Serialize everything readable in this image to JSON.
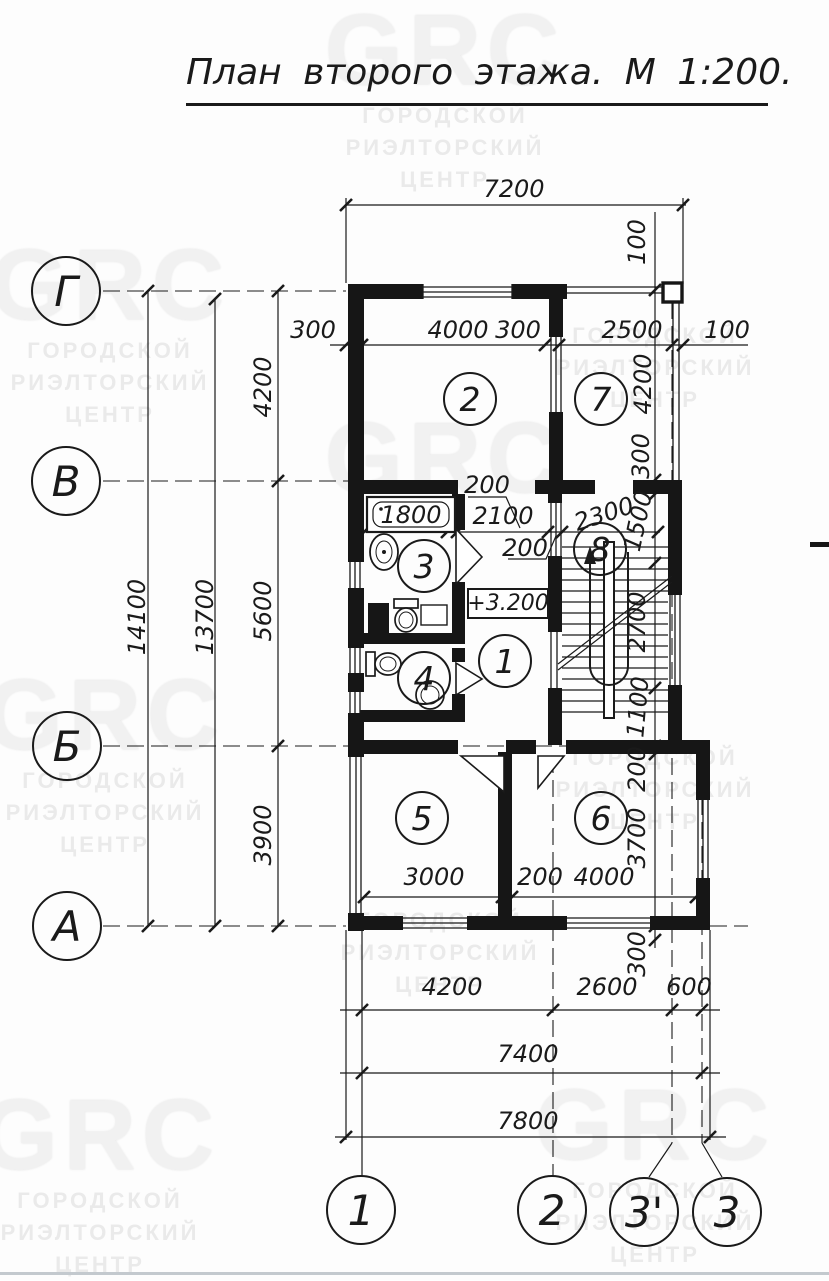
{
  "title": "План второго этажа. М 1:200.",
  "watermark": {
    "brand": "GRC",
    "lines": [
      "ГОРОДСКОЙ",
      "РИЭЛТОРСКИЙ",
      "ЦЕНТР"
    ]
  },
  "level_mark": "+3.200",
  "axes": {
    "left": [
      {
        "label": "Г",
        "x": 66,
        "y": 291
      },
      {
        "label": "В",
        "x": 66,
        "y": 481
      },
      {
        "label": "Б",
        "x": 67,
        "y": 746
      },
      {
        "label": "А",
        "x": 67,
        "y": 926
      }
    ],
    "bottom": [
      {
        "label": "1",
        "x": 361,
        "y": 1210
      },
      {
        "label": "2",
        "x": 552,
        "y": 1210
      },
      {
        "label": "3'",
        "x": 644,
        "y": 1212
      },
      {
        "label": "3",
        "x": 727,
        "y": 1212
      }
    ]
  },
  "rooms": [
    {
      "number": "2",
      "x": 470,
      "y": 399
    },
    {
      "number": "7",
      "x": 601,
      "y": 399
    },
    {
      "number": "3",
      "x": 424,
      "y": 566
    },
    {
      "number": "4",
      "x": 424,
      "y": 678
    },
    {
      "number": "1",
      "x": 505,
      "y": 661
    },
    {
      "number": "8",
      "x": 600,
      "y": 549
    },
    {
      "number": "5",
      "x": 422,
      "y": 818
    },
    {
      "number": "6",
      "x": 601,
      "y": 818
    }
  ],
  "dim_labels": [
    {
      "text": "7200",
      "x": 514,
      "y": 189,
      "r": 0
    },
    {
      "text": "100",
      "x": 637,
      "y": 242,
      "r": -90
    },
    {
      "text": "300",
      "x": 313,
      "y": 330,
      "r": 0
    },
    {
      "text": "4000",
      "x": 458,
      "y": 330,
      "r": 0
    },
    {
      "text": "300",
      "x": 518,
      "y": 330,
      "r": 0
    },
    {
      "text": "2500",
      "x": 632,
      "y": 330,
      "r": 0
    },
    {
      "text": "100",
      "x": 727,
      "y": 330,
      "r": 0
    },
    {
      "text": "14100",
      "x": 137,
      "y": 617,
      "r": -90
    },
    {
      "text": "13700",
      "x": 205,
      "y": 617,
      "r": -90
    },
    {
      "text": "4200",
      "x": 263,
      "y": 387,
      "r": -90
    },
    {
      "text": "5600",
      "x": 263,
      "y": 611,
      "r": -90
    },
    {
      "text": "3900",
      "x": 263,
      "y": 835,
      "r": -90
    },
    {
      "text": "1800",
      "x": 411,
      "y": 515,
      "r": 0
    },
    {
      "text": "200",
      "x": 487,
      "y": 485,
      "r": 0
    },
    {
      "text": "2100",
      "x": 503,
      "y": 516,
      "r": 0
    },
    {
      "text": "200",
      "x": 525,
      "y": 548,
      "r": 0
    },
    {
      "text": "2300",
      "x": 604,
      "y": 514,
      "r": -18
    },
    {
      "text": "4200",
      "x": 643,
      "y": 384,
      "r": -90
    },
    {
      "text": "300",
      "x": 641,
      "y": 456,
      "r": -90
    },
    {
      "text": "1500",
      "x": 638,
      "y": 521,
      "r": -78
    },
    {
      "text": "2700",
      "x": 637,
      "y": 622,
      "r": -90
    },
    {
      "text": "1100",
      "x": 638,
      "y": 707,
      "r": -85
    },
    {
      "text": "200",
      "x": 637,
      "y": 769,
      "r": -90
    },
    {
      "text": "3700",
      "x": 637,
      "y": 838,
      "r": -90
    },
    {
      "text": "300",
      "x": 637,
      "y": 954,
      "r": -90
    },
    {
      "text": "3000",
      "x": 434,
      "y": 877,
      "r": 0
    },
    {
      "text": "200",
      "x": 540,
      "y": 877,
      "r": 0
    },
    {
      "text": "4000",
      "x": 604,
      "y": 877,
      "r": 0
    },
    {
      "text": "4200",
      "x": 452,
      "y": 987,
      "r": 0
    },
    {
      "text": "2600",
      "x": 607,
      "y": 987,
      "r": 0
    },
    {
      "text": "600",
      "x": 689,
      "y": 987,
      "r": 0
    },
    {
      "text": "7400",
      "x": 528,
      "y": 1054,
      "r": 0
    },
    {
      "text": "7800",
      "x": 528,
      "y": 1121,
      "r": 0
    }
  ],
  "watermarks": [
    {
      "x": 445,
      "y": 0,
      "grc": true,
      "lines": true
    },
    {
      "x": 110,
      "y": 235,
      "grc": true,
      "lines": true
    },
    {
      "x": 655,
      "y": 320,
      "grc": false,
      "lines": true
    },
    {
      "x": 445,
      "y": 408,
      "grc": true,
      "lines": false
    },
    {
      "x": 105,
      "y": 665,
      "grc": true,
      "lines": true
    },
    {
      "x": 655,
      "y": 742,
      "grc": false,
      "lines": true
    },
    {
      "x": 440,
      "y": 905,
      "grc": false,
      "lines": true
    },
    {
      "x": 100,
      "y": 1085,
      "grc": true,
      "lines": true
    },
    {
      "x": 655,
      "y": 1075,
      "grc": true,
      "lines": true
    }
  ]
}
